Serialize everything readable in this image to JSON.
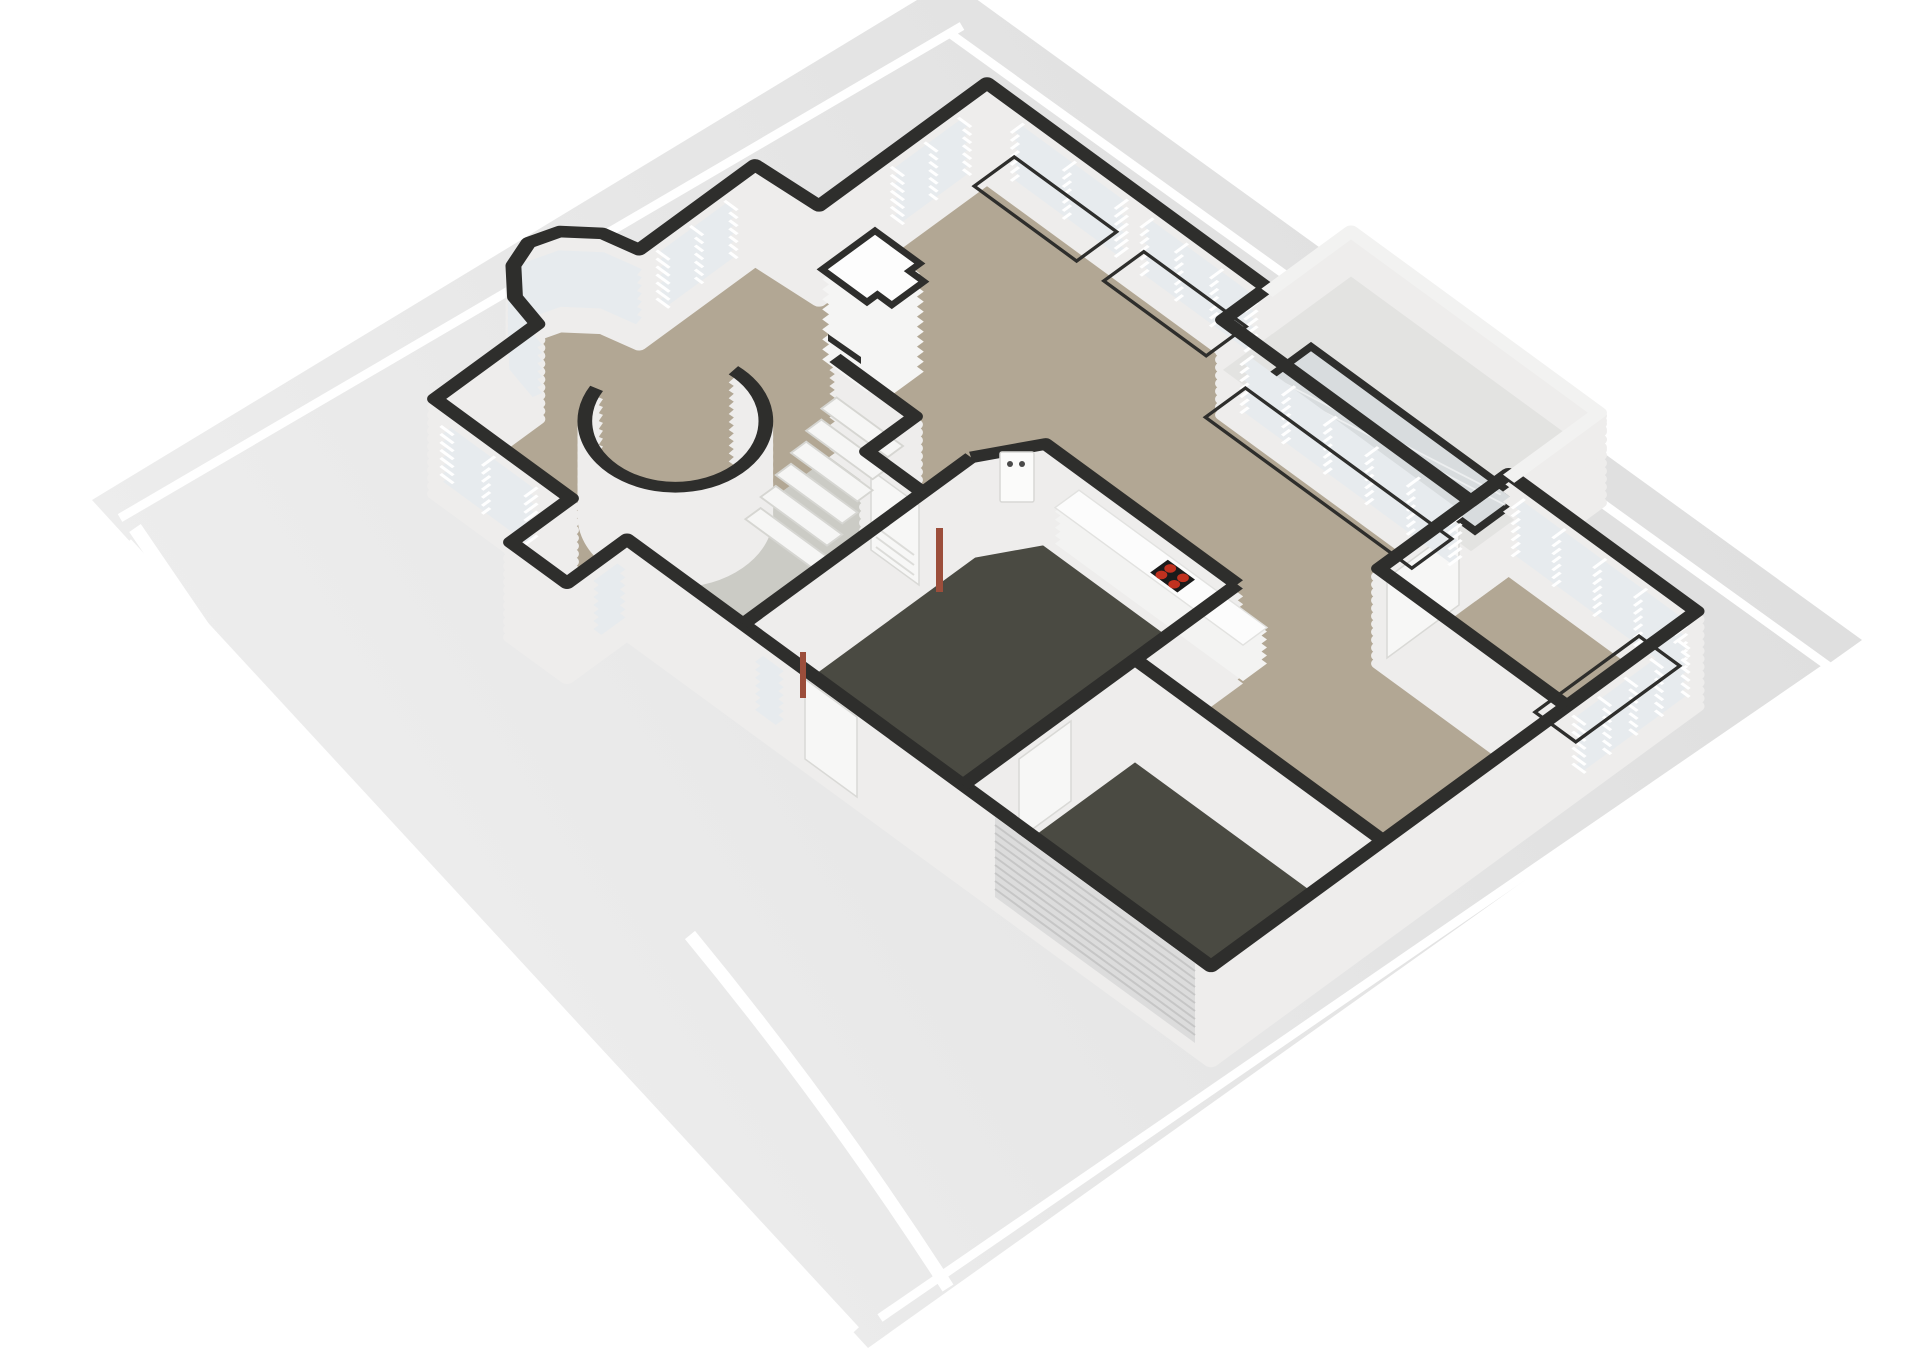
{
  "scene": {
    "kind": "3d-floorplan-isometric-render",
    "floor_shown": "ground-floor",
    "stove_burner_count": 4,
    "stair_step_count": 6
  },
  "colors": {
    "background": "#ffffff",
    "ground": "#e2e2e2",
    "ground_light": "#eeeeee",
    "marking_white": "#ffffff",
    "floor_main": "#b2a794",
    "floor_hall": "#cbcbc5",
    "floor_dark": "#4a4a42",
    "roof_terrace": "#e3e3e1",
    "skylight_glass": "#d8dcde",
    "wall_top": "#2e2e2c",
    "wall_side": "#eeedec",
    "parapet_top": "#f2f2f1",
    "glass": "#e7ebee",
    "frame_white": "#ffffff",
    "counter_side": "#f3f3f2",
    "counter_top": "#fcfcfc",
    "stove_plate": "#1b1b1b",
    "stove_burner": "#c1311f",
    "door_white": "#f7f7f6",
    "wood_accent": "#9c4e3b",
    "garage_door": "#dcdcdc",
    "garage_door_rib": "#c6c6c6",
    "stair_tread": "#f6f6f5",
    "stair_edge": "#d6d6d2",
    "fireplace_top": "#fdfdfd",
    "boiler_dot": "#4a4a4a"
  }
}
